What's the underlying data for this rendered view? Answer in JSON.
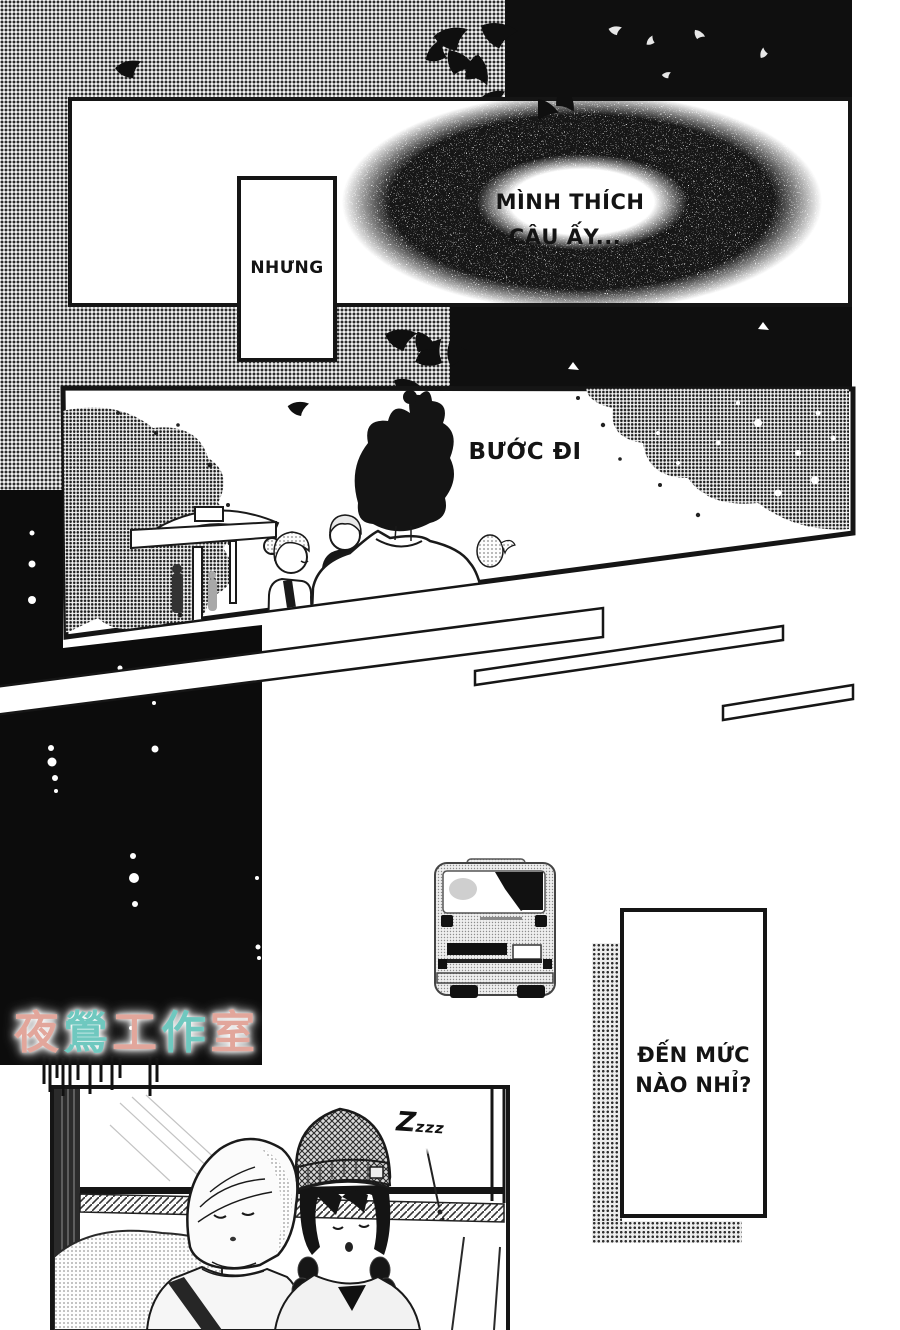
{
  "page_type": "manga-page",
  "ink_color": "#151515",
  "panel1": {
    "thought_line1": "MÌNH THÍCH",
    "thought_line2": "CẬU ẤY...",
    "caption": "NHƯNG"
  },
  "panel2": {
    "caption": "BƯỚC ĐI"
  },
  "panel3": {
    "sleep_sfx": "Zzzz"
  },
  "floating_caption": {
    "line1": "ĐẾN MỨC",
    "line2": "NÀO NHỈ?"
  },
  "watermark": {
    "text": "夜鶯工作室",
    "colors": [
      "#e2a69b",
      "#6fc8bf",
      "#e2a69b",
      "#6fc8bf",
      "#e2a69b"
    ]
  }
}
